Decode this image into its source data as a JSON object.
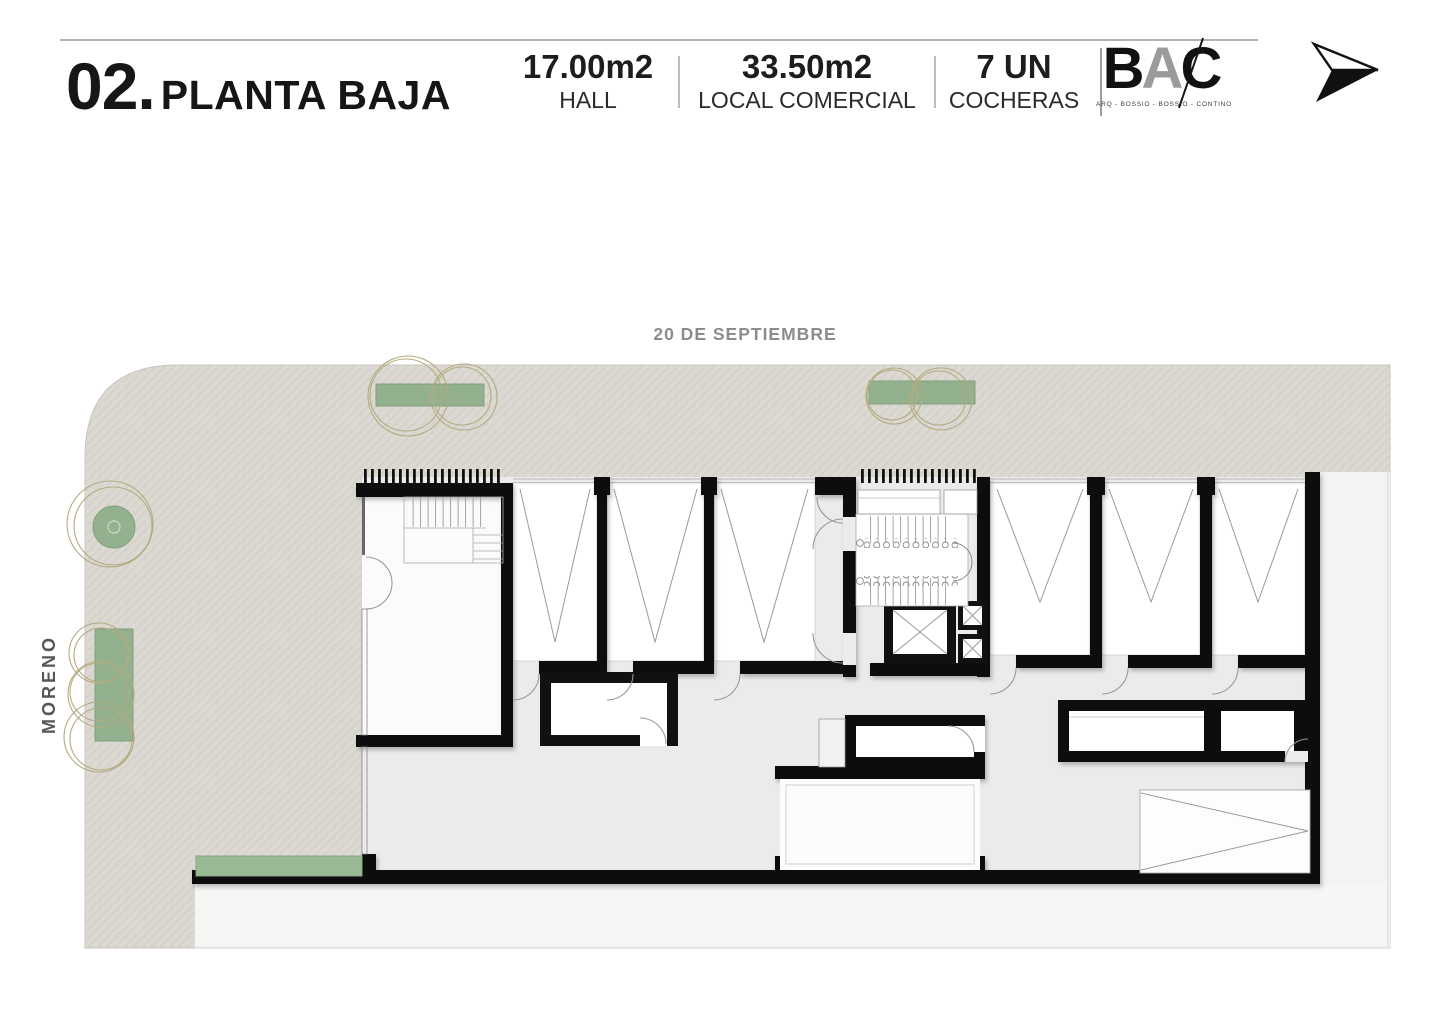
{
  "header": {
    "number": "02.",
    "title": "PLANTA BAJA",
    "stats": [
      {
        "value": "17.00m2",
        "label": "HALL"
      },
      {
        "value": "33.50m2",
        "label": "LOCAL COMERCIAL"
      },
      {
        "value": "7 UN",
        "label": "COCHERAS"
      }
    ],
    "logo": {
      "part_b": "B",
      "part_a": "A",
      "part_c": "C",
      "caption": "ARQ - BOSSIO - BOSSIO - CONTINO"
    }
  },
  "plan": {
    "streets": {
      "top": "20 DE SEPTIEMBRE",
      "left": "MORENO"
    }
  },
  "icons": {
    "arrow": "paper-plane-right-icon"
  },
  "colors": {
    "green_planter": "#93b18e",
    "green_strip": "#9aba95",
    "tree_outline": "#b3ab80",
    "sidewalk": "#dcd9d3",
    "wall": "#111111",
    "street_label_top": "#8c8c8c",
    "street_label_left": "#55555c",
    "interior_floor": "#ebebeb"
  }
}
